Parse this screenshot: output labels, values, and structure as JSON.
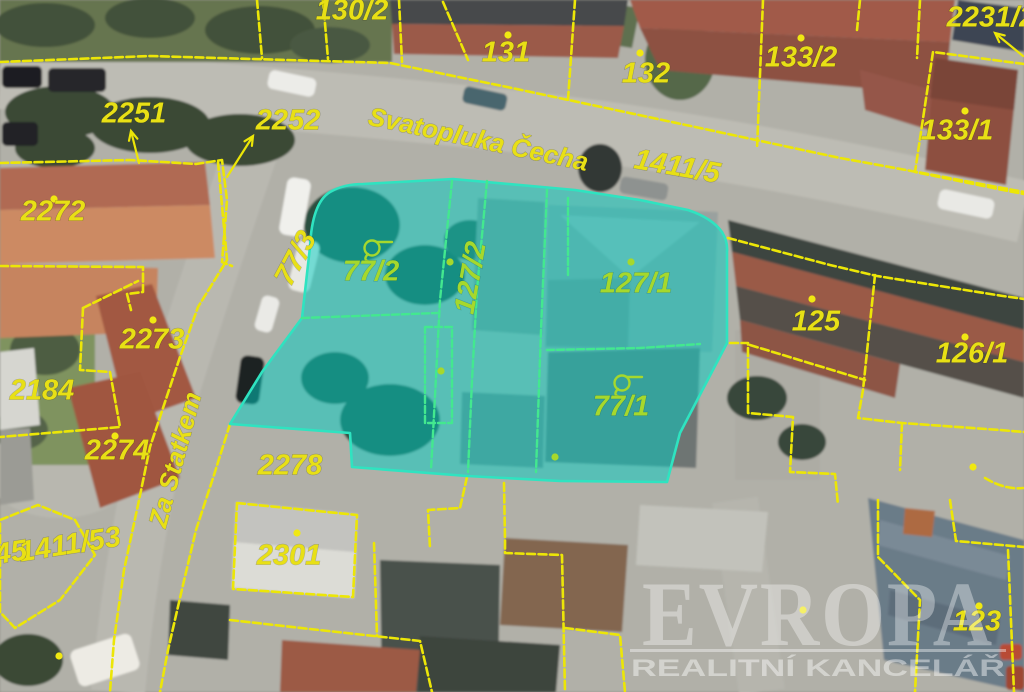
{
  "watermark": {
    "brand": "EVROPA",
    "subtitle": "REALITNÍ KANCELÁŘ"
  },
  "map": {
    "colors": {
      "boundary": "#ece607",
      "label": "#e8e015",
      "green_label": "#a6d82c",
      "green_line": "#43e88f",
      "dot": "#f0e812",
      "highlight_fill": "rgba(0,205,195,0.50)",
      "highlight_stroke": "#2fe3c0"
    },
    "streets": [
      {
        "name": "Svatopluka Čecha",
        "x": 478,
        "y": 141,
        "rotate": 12
      },
      {
        "name": "Za Statkem",
        "x": 177,
        "y": 460,
        "rotate": -75
      }
    ],
    "parcel_labels": [
      {
        "n": "130/2",
        "x": 352,
        "y": 12,
        "rotate": 0
      },
      {
        "n": "131",
        "x": 506,
        "y": 54,
        "rotate": 0
      },
      {
        "n": "132",
        "x": 646,
        "y": 75,
        "rotate": 0
      },
      {
        "n": "133/2",
        "x": 801,
        "y": 59,
        "rotate": 0
      },
      {
        "n": "2231/2",
        "x": 991,
        "y": 19,
        "rotate": 0
      },
      {
        "n": "133/1",
        "x": 957,
        "y": 132,
        "rotate": 0
      },
      {
        "n": "2251",
        "x": 134,
        "y": 115,
        "rotate": 0
      },
      {
        "n": "2252",
        "x": 288,
        "y": 122,
        "rotate": 0
      },
      {
        "n": "1411/5",
        "x": 677,
        "y": 168,
        "rotate": 10
      },
      {
        "n": "2272",
        "x": 53,
        "y": 213,
        "rotate": 0
      },
      {
        "n": "2273",
        "x": 152,
        "y": 341,
        "rotate": 0
      },
      {
        "n": "2184",
        "x": 42,
        "y": 392,
        "rotate": 0
      },
      {
        "n": "2274",
        "x": 117,
        "y": 452,
        "rotate": 0
      },
      {
        "n": "1411/53",
        "x": 70,
        "y": 546,
        "rotate": -9
      },
      {
        "n": "45",
        "x": 11,
        "y": 554,
        "rotate": -9
      },
      {
        "n": "77/3",
        "x": 297,
        "y": 259,
        "rotate": -62
      },
      {
        "n": "125",
        "x": 816,
        "y": 323,
        "rotate": 0
      },
      {
        "n": "126/1",
        "x": 972,
        "y": 355,
        "rotate": 0
      },
      {
        "n": "2278",
        "x": 290,
        "y": 467,
        "rotate": 0
      },
      {
        "n": "2301",
        "x": 289,
        "y": 557,
        "rotate": 0
      },
      {
        "n": "123",
        "x": 977,
        "y": 623,
        "rotate": 0
      },
      {
        "n": "77/2",
        "x": 371,
        "y": 273,
        "rotate": 0,
        "c": "g"
      },
      {
        "n": "127/2",
        "x": 472,
        "y": 278,
        "rotate": -80,
        "c": "g"
      },
      {
        "n": "127/1",
        "x": 636,
        "y": 285,
        "rotate": 0,
        "c": "g"
      },
      {
        "n": "77/1",
        "x": 621,
        "y": 408,
        "rotate": 0,
        "c": "g"
      }
    ],
    "dots": [
      {
        "x": 508,
        "y": 35
      },
      {
        "x": 640,
        "y": 53
      },
      {
        "x": 801,
        "y": 38
      },
      {
        "x": 965,
        "y": 111
      },
      {
        "x": 54,
        "y": 199
      },
      {
        "x": 153,
        "y": 320
      },
      {
        "x": 115,
        "y": 436
      },
      {
        "x": 812,
        "y": 299
      },
      {
        "x": 965,
        "y": 337
      },
      {
        "x": 297,
        "y": 533
      },
      {
        "x": 979,
        "y": 606
      },
      {
        "x": 973,
        "y": 467
      },
      {
        "x": 59,
        "y": 656
      },
      {
        "x": 803,
        "y": 610
      },
      {
        "x": 450,
        "y": 262,
        "c": "g"
      },
      {
        "x": 631,
        "y": 262,
        "c": "g"
      },
      {
        "x": 441,
        "y": 371,
        "c": "g"
      },
      {
        "x": 555,
        "y": 457,
        "c": "g"
      }
    ],
    "arrows": [
      {
        "x1": 139,
        "y1": 163,
        "x2": 131,
        "y2": 131
      },
      {
        "x1": 227,
        "y1": 177,
        "x2": 253,
        "y2": 136
      },
      {
        "x1": 1023,
        "y1": 56,
        "x2": 995,
        "y2": 33
      }
    ],
    "symbols": [
      {
        "x": 372,
        "y": 248
      },
      {
        "x": 622,
        "y": 383
      }
    ],
    "highlight": {
      "path": "M363,184 L453,179 L575,190 L640,200 L688,210 Q712,218 722,232 Q728,242 727,252 L727,343 L680,433 L667,482 L560,481 L467,476 L352,467 L350,433 L230,424 L262,372 L302,318 L310,247 Q312,203 330,192 Q344,184 363,184 Z",
      "inner_lines": [
        "M452,181 L440,300 L434,415 L431,470",
        "M487,181 L477,290 L472,380 L468,472",
        "M547,190 L541,330 L536,472",
        "M302,318 L437,313",
        "M425,327 L452,327 L452,423 L425,423 Z",
        "M547,350 L640,348 L700,344",
        "M568,198 L568,276"
      ],
      "parcels": [
        "77/2",
        "127/2",
        "127/1",
        "77/1"
      ]
    },
    "boundaries": [
      "M0,62 L150,56 L390,63 L512,88 L700,128 L840,158 L917,172 L1024,192",
      "M257,0 L262,58",
      "M323,0 L328,59",
      "M399,0 L402,62",
      "M443,2 L468,60",
      "M575,0 L568,100",
      "M763,0 L757,149",
      "M920,0 L917,58",
      "M860,0 L857,30",
      "M1024,64 L933,52 L915,172 L1003,190 L1024,194",
      "M0,163 L130,160 L196,164 L222,160 L227,200 L222,262 L232,266",
      "M0,266 L143,267 L143,292 L127,294 L131,310",
      "M83,308 L138,281",
      "M83,308 L80,370 L110,372 L120,427 L0,437",
      "M218,162 L227,260 L198,307 L180,357 L150,447 L138,505 L124,570 L114,640 L110,692",
      "M230,424 L214,475 L196,530 L183,585 L168,650 L160,692",
      "M0,520 L38,505 L75,520 L95,555 L60,600 L15,628 L0,612 Z",
      "M467,477 L460,508 L428,510 L430,548",
      "M237,503 L357,515 L353,597 L233,589 Z",
      "M230,620 L310,629 L374,636 L420,641 L432,692",
      "M374,543 L377,636",
      "M504,483 L505,540 L505,553 L562,555 L565,692",
      "M565,628 L620,635 L625,692",
      "M728,238 L830,265 L877,276 L1003,296 L1024,299",
      "M730,343 L748,343 L748,413 L793,417 L790,472 L835,474 L838,505",
      "M875,275 L863,390 L858,418 L902,423 L1000,430 L1024,432",
      "M750,345 L865,380",
      "M902,423 L900,470",
      "M878,500 L878,557 L920,600 L915,692",
      "M950,500 L956,541 L1024,547",
      "M1008,550 L1014,692",
      "M985,478 Q1005,490 1023,488"
    ]
  }
}
